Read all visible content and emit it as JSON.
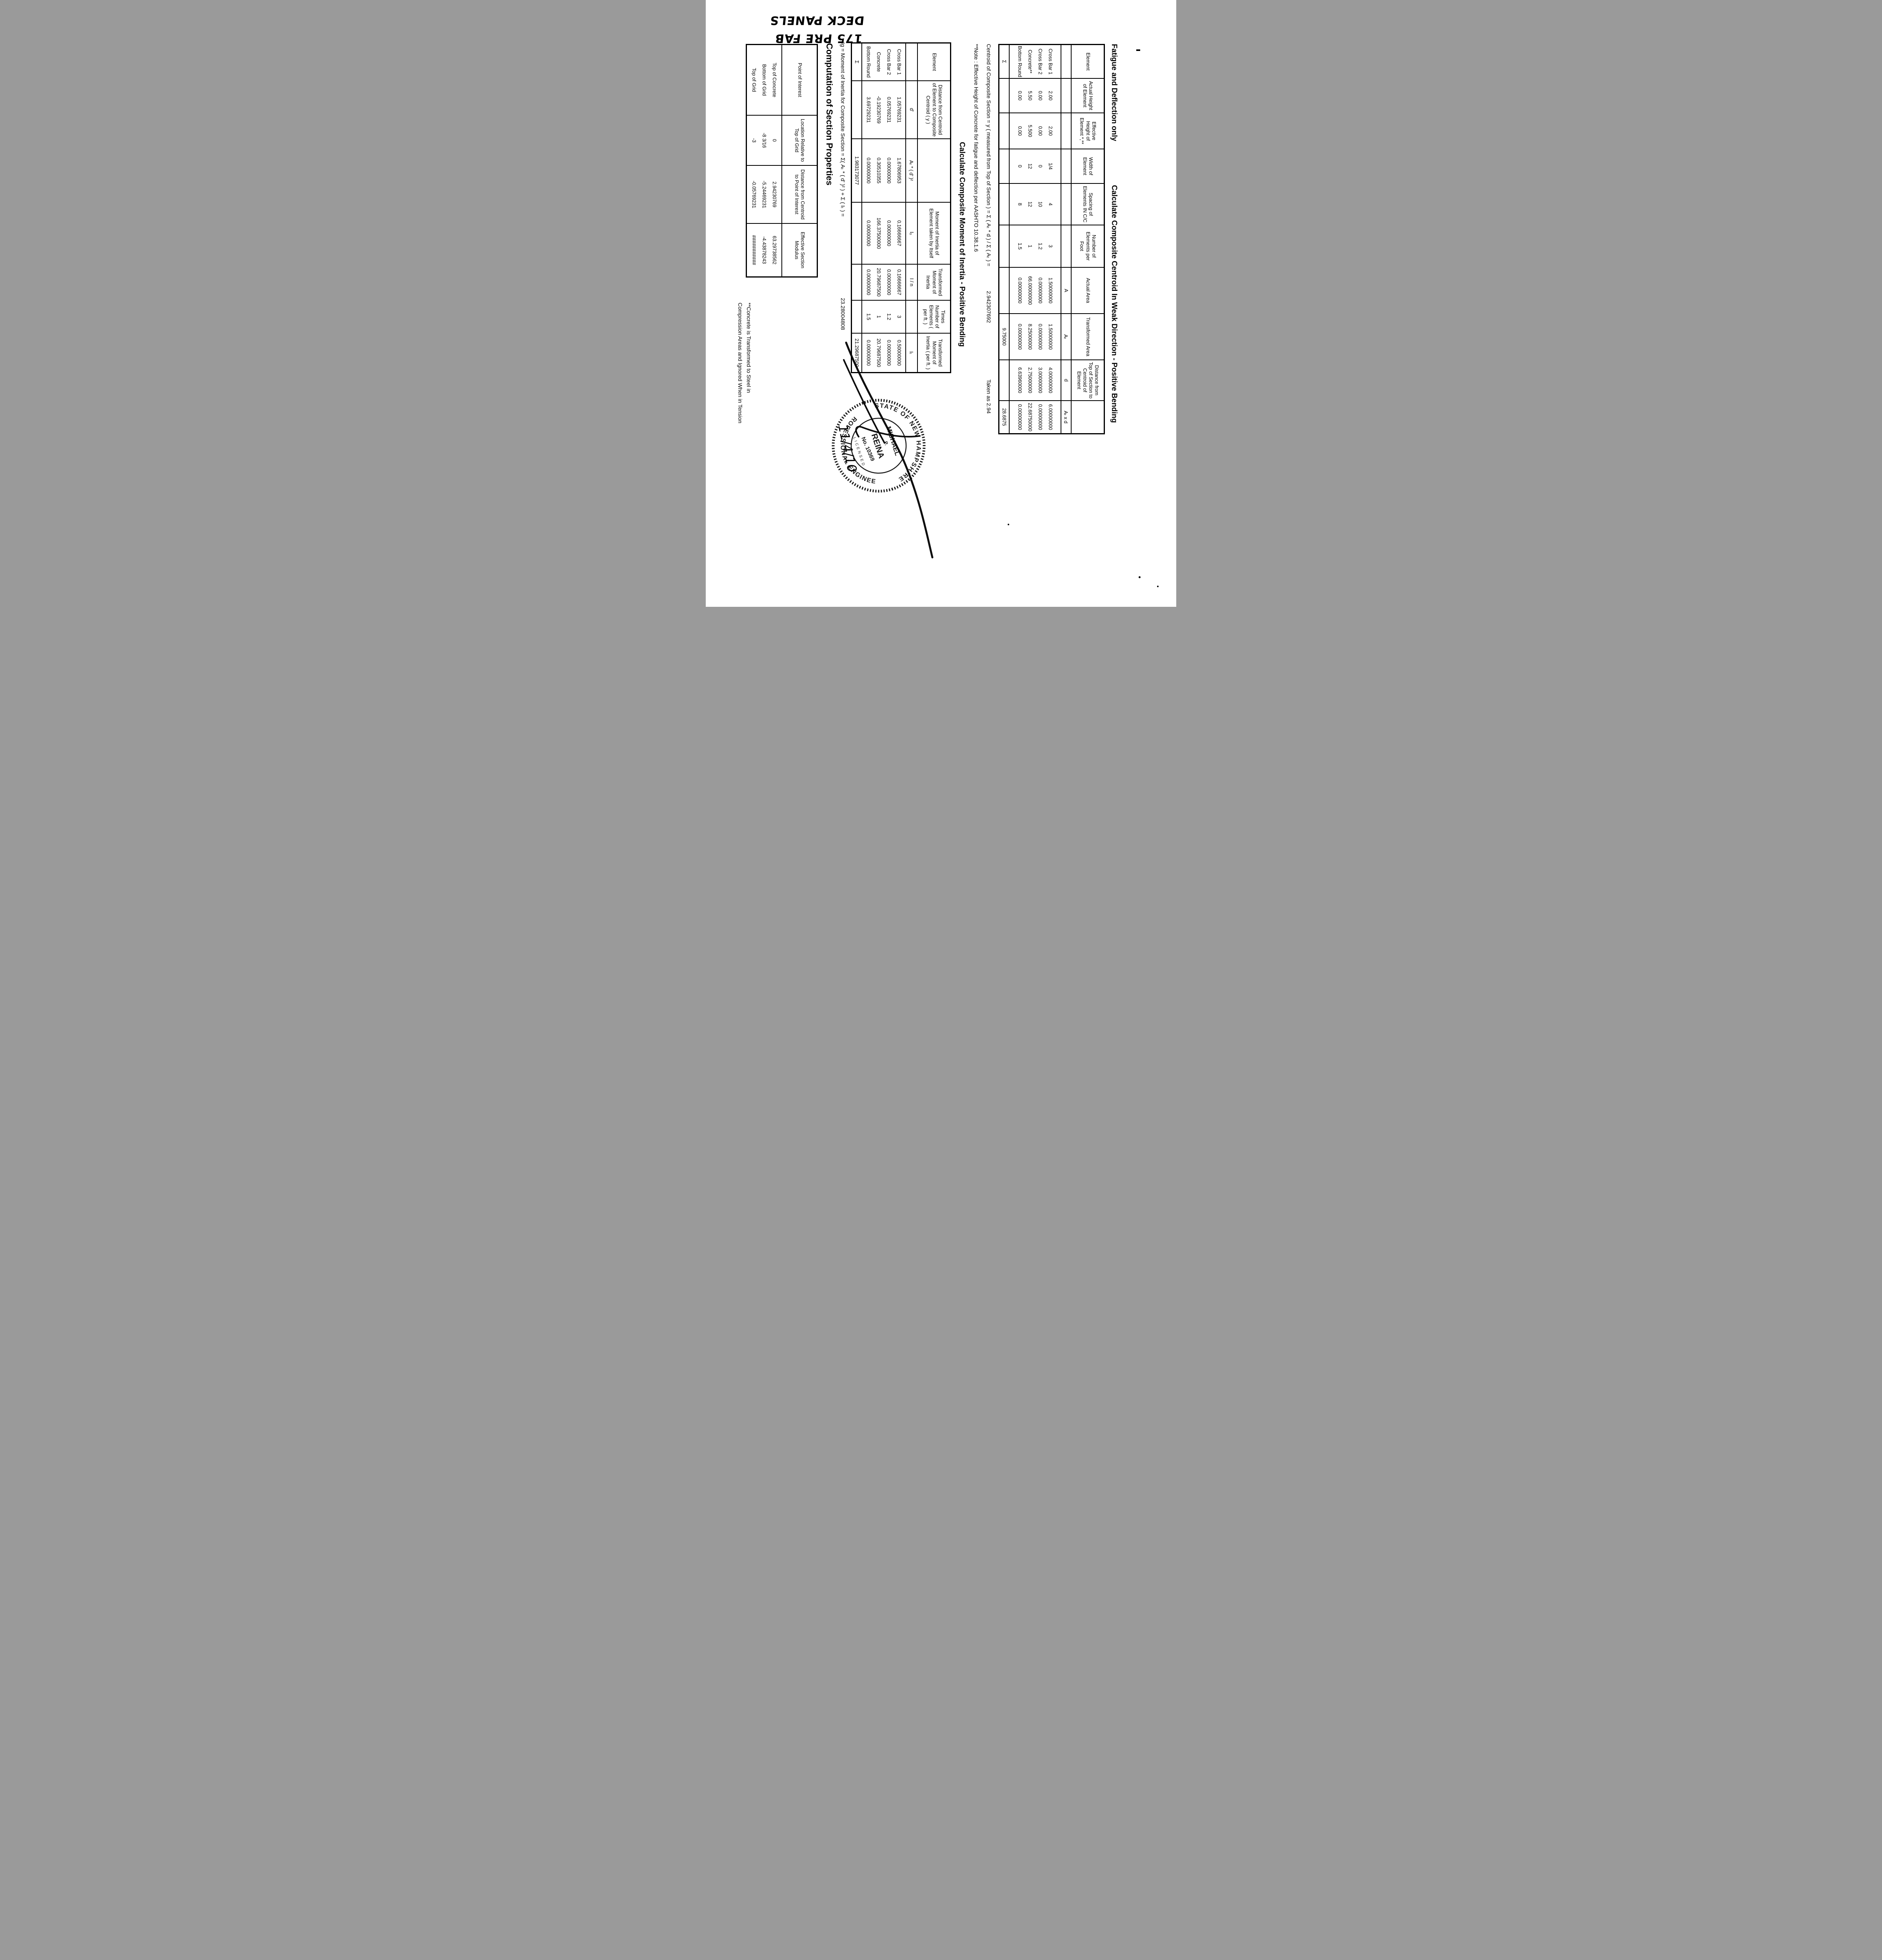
{
  "note": {
    "line1": "175 PRE FAB",
    "line2": "DECK PANELS"
  },
  "titles": {
    "fatigue": "Fatigue and Deflection only",
    "centroid": "Calculate Composite Centroid In Weak Direction - Positive Bending",
    "inertia": "Calculate Composite Moment of Inertia - Positive Bending",
    "section_props": "Computation of Section Properties"
  },
  "formulas": {
    "centroid_eq": "Centroid of Composite Section = y ( measured from Top of Section ) = Σ ( Aₜ * d ) / Σ ( Aₜ ) =",
    "centroid_value": "2.942307692",
    "centroid_taken": "Taken as 2.94",
    "note_line": "**Note : Effective Height of Concrete for fatigue and deflection per AASHTO 10.38.1.6",
    "ig_eq": "Ig = Moment of Inertia for Composite Section = Σ( Aₜ * ( d' )² ) + Σ ( Iₜ ) =",
    "ig_value": "23.28004808",
    "footnote1": "**Concrete is Transformed to Steel in",
    "footnote2": "Compression Areas and Ignored When in Tension"
  },
  "table1": {
    "columns": [
      {
        "header": "Element",
        "symbol": "",
        "values": [
          "Cross Bar 1",
          "Cross Bar 2",
          "Concrete**",
          "Bottom Round"
        ],
        "sigma": "Σ"
      },
      {
        "header": "Actual Height of Element",
        "symbol": "",
        "values": [
          "2.00",
          "0.00",
          "5.50",
          "0.00"
        ],
        "sigma": ""
      },
      {
        "header": "Effective Height of Element *,**",
        "symbol": "",
        "values": [
          "2.00",
          "0.00",
          "5.500",
          "0.00"
        ],
        "sigma": ""
      },
      {
        "header": "Width of Element",
        "symbol": "",
        "values": [
          "1/4",
          "0",
          "12",
          "0"
        ],
        "sigma": ""
      },
      {
        "header": "Spacing of Elements IN C/C",
        "symbol": "",
        "values": [
          "4",
          "10",
          "12",
          "8"
        ],
        "sigma": ""
      },
      {
        "header": "Number of Elements per Foot",
        "symbol": "",
        "values": [
          "3",
          "1.2",
          "1",
          "1.5"
        ],
        "sigma": ""
      },
      {
        "header": "Actual Area",
        "symbol": "A",
        "values": [
          "1.50000000",
          "0.00000000",
          "66.00000000",
          "0.00000000"
        ],
        "sigma": ""
      },
      {
        "header": "Transformed Area",
        "symbol": "Aₜ",
        "values": [
          "1.50000000",
          "0.00000000",
          "8.25000000",
          "0.00000000"
        ],
        "sigma": "9.75000"
      },
      {
        "header": "Distance from Top of Section to Centroid of Element",
        "symbol": "d",
        "values": [
          "4.00000000",
          "3.00000000",
          "2.75000000",
          "6.63960000"
        ],
        "sigma": ""
      },
      {
        "header": "",
        "symbol": "Aₜ x d",
        "values": [
          "6.00000000",
          "0.00000000",
          "22.68750000",
          "0.00000000"
        ],
        "sigma": "28.6875"
      }
    ]
  },
  "table2": {
    "columns": [
      {
        "header": "Element",
        "symbol": "",
        "values": [
          "Cross Bar 1",
          "Cross Bar 2",
          "Concrete",
          "Bottom Round"
        ],
        "sigma": "Σ"
      },
      {
        "header": "Distance from Centroid of Element to Composite Centroid ( y )",
        "symbol": "d'",
        "values": [
          "1.05769231",
          "0.05769231",
          "-0.19230769",
          "3.69729231"
        ],
        "sigma": ""
      },
      {
        "header": "",
        "symbol": "Aₜ * ( d' )²",
        "values": [
          "1.67806953",
          "0.00000000",
          "0.30510355",
          "0.00000000"
        ],
        "sigma": "1.983173077"
      },
      {
        "header": "Moment of Inertia of Element taken by Itself",
        "symbol": "Iₒ",
        "values": [
          "0.16666667",
          "0.00000000",
          "166.37500000",
          "0.00000000"
        ],
        "sigma": ""
      },
      {
        "header": "Transformed Moment of Inertia",
        "symbol": "I / n",
        "values": [
          "0.16666667",
          "0.00000000",
          "20.79687500",
          "0.00000000"
        ],
        "sigma": ""
      },
      {
        "header": "Times Number of Elements ( per ft. )",
        "symbol": "",
        "values": [
          "3",
          "1.2",
          "1",
          "1.5"
        ],
        "sigma": ""
      },
      {
        "header": "Transformed Moment of Inertia ( per ft. )",
        "symbol": "Iₜ",
        "values": [
          "0.50000000",
          "0.00000000",
          "20.79687500",
          "0.00000000"
        ],
        "sigma": "21.29687500"
      }
    ]
  },
  "table3": {
    "columns": [
      {
        "header": "Point of Interest",
        "values": [
          "Top of Concrete",
          "Bottom of Grid",
          "Top of Grid"
        ]
      },
      {
        "header": "Location Relative to Top of Grid",
        "values": [
          "0",
          "-8 3/16",
          "-3"
        ]
      },
      {
        "header": "Distance from Centroid to Point of Interest",
        "values": [
          "2.94230769",
          "-5.24469231",
          "-0.05769231"
        ]
      },
      {
        "header": "Effective Section Modulus",
        "values": [
          "63.29738562",
          "-4.43878243",
          "###########"
        ]
      }
    ]
  },
  "stamp": {
    "state": "STATE OF NEW HAMPSHIRE",
    "profession": "PROFESSIONAL ENGINEER",
    "first_name": "MICHAEL",
    "middle": "P.",
    "last_name": "REINA",
    "license": "No. 10369",
    "licensed": "LICENSED",
    "date": "11/4/10"
  }
}
